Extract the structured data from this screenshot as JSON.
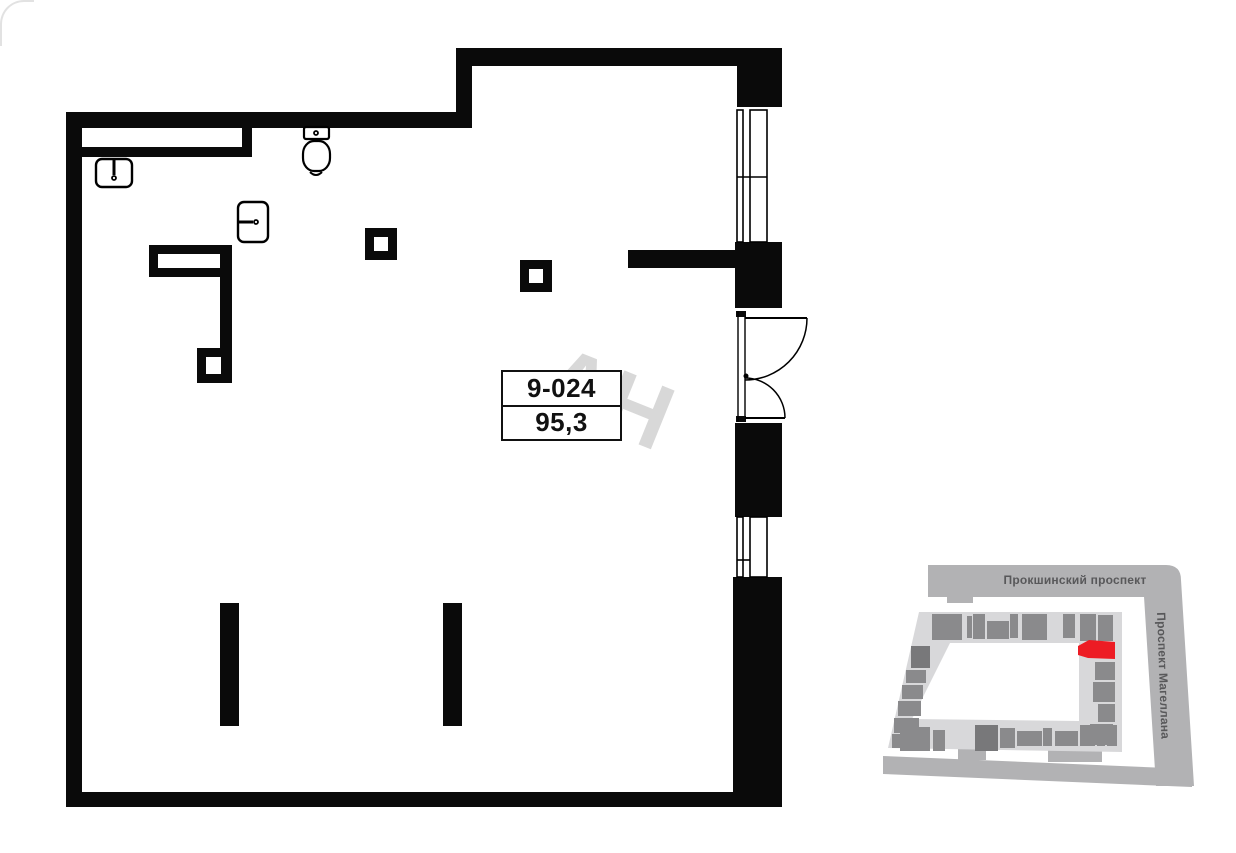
{
  "unit_label": {
    "number": "9-024",
    "area": "95,3"
  },
  "watermark": {
    "text": "АН",
    "color": "#d8d8d8",
    "rotation_deg": 22
  },
  "plan": {
    "wall_color": "#0a0a0a",
    "walls": [
      [
        66,
        112,
        16,
        695
      ],
      [
        66,
        112,
        406,
        16
      ],
      [
        456,
        48,
        16,
        80
      ],
      [
        456,
        48,
        326,
        18
      ],
      [
        737,
        48,
        45,
        59
      ],
      [
        735,
        242,
        47,
        66
      ],
      [
        735,
        423,
        47,
        94
      ],
      [
        733,
        577,
        49,
        230
      ],
      [
        66,
        792,
        716,
        15
      ],
      [
        628,
        250,
        107,
        18
      ],
      [
        81,
        147,
        171,
        10
      ],
      [
        242,
        128,
        10,
        29
      ],
      [
        149,
        245,
        83,
        32
      ],
      [
        220,
        277,
        12,
        106
      ],
      [
        197,
        348,
        35,
        35
      ],
      [
        365,
        228,
        32,
        32
      ],
      [
        520,
        260,
        32,
        32
      ],
      [
        220,
        603,
        19,
        123
      ],
      [
        443,
        603,
        19,
        123
      ],
      [
        736,
        311,
        10,
        6
      ],
      [
        736,
        416,
        10,
        6
      ]
    ],
    "holes": [
      [
        158,
        254,
        62,
        14
      ],
      [
        206,
        357,
        15,
        17
      ],
      [
        374,
        237,
        14,
        14
      ],
      [
        529,
        269,
        14,
        14
      ]
    ],
    "windows": [
      {
        "glazing": [
          737,
          110,
          6,
          132
        ],
        "frame": [
          750,
          110,
          17,
          132
        ],
        "mullion": [
          737,
          177,
          767,
          177
        ]
      },
      {
        "glazing": [
          737,
          517,
          6,
          60
        ],
        "frame": [
          750,
          517,
          17,
          60
        ],
        "mullion": [
          737,
          560,
          750,
          560
        ]
      }
    ],
    "door": {
      "edge_lines": [
        [
          738,
          311,
          738,
          422
        ],
        [
          745,
          317,
          745,
          416
        ]
      ],
      "leaves": [
        [
          745,
          318,
          807,
          318
        ],
        [
          745,
          418,
          785,
          418
        ]
      ],
      "swings": [
        "M807,318 A62,62 0 0 1 745,380",
        "M785,418 A40,40 0 0 0 745,378"
      ],
      "hinge_dot": [
        746,
        376,
        2.5
      ]
    },
    "fixtures": {
      "sink_top_left": {
        "body": [
          96,
          159,
          36,
          28,
          6
        ],
        "tap": [
          114,
          158,
          114,
          175
        ],
        "drain": [
          114,
          178,
          2
        ]
      },
      "sink_middle": {
        "body": [
          238,
          202,
          30,
          40,
          6
        ],
        "tap": [
          237,
          222,
          253,
          222
        ],
        "drain": [
          256,
          222,
          2
        ]
      },
      "toilet": {
        "tank": [
          304,
          127,
          25,
          12,
          2
        ],
        "tank_dot": [
          316,
          133,
          2
        ],
        "bowl": [
          303,
          141,
          27,
          30,
          11
        ],
        "smile": "M310,172 Q316,178 322,172"
      }
    }
  },
  "map": {
    "streets": {
      "top_label": "Прокшинский проспект",
      "right_label": "Проспект Магеллана"
    },
    "palette": {
      "street": "#b2b2b4",
      "street_text": "#58585a",
      "ring": "#d8d8da",
      "unit": "#8a8a8c",
      "unit_dark": "#78787a",
      "highlight": "#ed1c24"
    },
    "street_shapes": [
      "M48,7 L278,7 L278,39 L48,39 Z",
      "M67,39 h26 v6 h-26 Z",
      "M262,7 L286,7 Q301,7 301,22 L314,228 L276,228 Z",
      "M3,198 L312,211 L312,229 L3,216 Z",
      "M78,190 h28 v12 h-28 Z",
      "M168,190 h54 v14 h-54 Z"
    ],
    "ring_path": "M39,54 L242,54 L242,194 L8,190 Z M70,85 L199,85 L199,163 L32,161 Z",
    "units": [
      [
        52,
        56,
        30,
        26
      ],
      [
        87,
        58,
        5,
        22
      ],
      [
        93,
        56,
        12,
        25
      ],
      [
        107,
        63,
        22,
        18
      ],
      [
        130,
        56,
        8,
        24
      ],
      [
        142,
        56,
        25,
        26
      ],
      [
        183,
        56,
        12,
        24
      ],
      [
        200,
        56,
        16,
        27
      ],
      [
        218,
        57,
        15,
        26
      ],
      [
        31,
        88,
        19,
        22
      ],
      [
        26,
        112,
        20,
        13
      ],
      [
        22,
        127,
        21,
        14
      ],
      [
        18,
        143,
        23,
        15
      ],
      [
        14,
        160,
        25,
        15
      ],
      [
        12,
        176,
        25,
        14
      ],
      [
        20,
        169,
        30,
        24
      ],
      [
        53,
        172,
        12,
        21
      ],
      [
        120,
        170,
        15,
        20
      ],
      [
        137,
        173,
        25,
        15
      ],
      [
        163,
        170,
        9,
        18
      ],
      [
        175,
        173,
        23,
        15
      ],
      [
        200,
        167,
        15,
        21
      ],
      [
        217,
        173,
        8,
        15
      ],
      [
        227,
        167,
        10,
        21
      ],
      [
        215,
        104,
        20,
        18
      ],
      [
        213,
        124,
        22,
        20
      ],
      [
        218,
        146,
        17,
        18
      ],
      [
        210,
        166,
        23,
        21
      ]
    ],
    "dark_units": [
      [
        95,
        167,
        23,
        26
      ],
      [
        31,
        88,
        19,
        22
      ]
    ],
    "highlight_points": "198,88 209,82 235,84 235,101 208,100 198,97"
  }
}
